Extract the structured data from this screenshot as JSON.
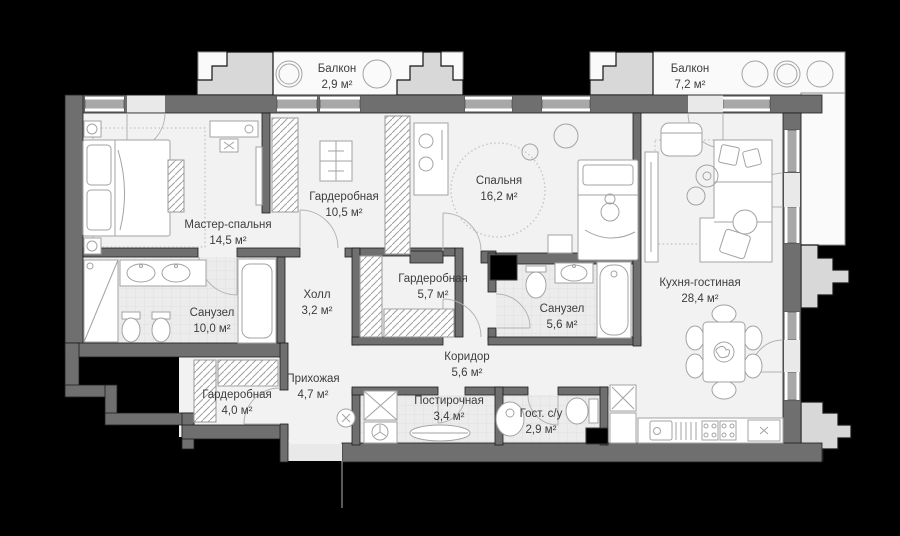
{
  "plan": {
    "colors": {
      "background": "#000000",
      "wall": "#6f6f6f",
      "floor": "#f2f2f2",
      "tile_floor": "#ececec",
      "balcony_floor": "#fafafa",
      "step_block": "#d8d8d8",
      "label_text": "#3d3d3d"
    },
    "rooms": [
      {
        "id": "balcony-left",
        "name": "Балкон",
        "area": "2,9 м²"
      },
      {
        "id": "balcony-right",
        "name": "Балкон",
        "area": "7,2 м²"
      },
      {
        "id": "master-bedroom",
        "name": "Мастер-спальня",
        "area": "14,5 м²"
      },
      {
        "id": "wardrobe-master",
        "name": "Гардеробная",
        "area": "10,5 м²"
      },
      {
        "id": "bedroom",
        "name": "Спальня",
        "area": "16,2 м²"
      },
      {
        "id": "kitchen-living",
        "name": "Кухня-гостиная",
        "area": "28,4 м²"
      },
      {
        "id": "bathroom-master",
        "name": "Санузел",
        "area": "10,0 м²"
      },
      {
        "id": "hall",
        "name": "Холл",
        "area": "3,2 м²"
      },
      {
        "id": "wardrobe-middle",
        "name": "Гардеробная",
        "area": "5,7 м²"
      },
      {
        "id": "bathroom-second",
        "name": "Санузел",
        "area": "5,6 м²"
      },
      {
        "id": "corridor",
        "name": "Коридор",
        "area": "5,6 м²"
      },
      {
        "id": "entry-hall",
        "name": "Прихожая",
        "area": "4,7 м²"
      },
      {
        "id": "wardrobe-entry",
        "name": "Гардеробная",
        "area": "4,0 м²"
      },
      {
        "id": "laundry",
        "name": "Постирочная",
        "area": "3,4 м²"
      },
      {
        "id": "guest-wc",
        "name": "Гост. с/у",
        "area": "2,9 м²"
      }
    ]
  }
}
